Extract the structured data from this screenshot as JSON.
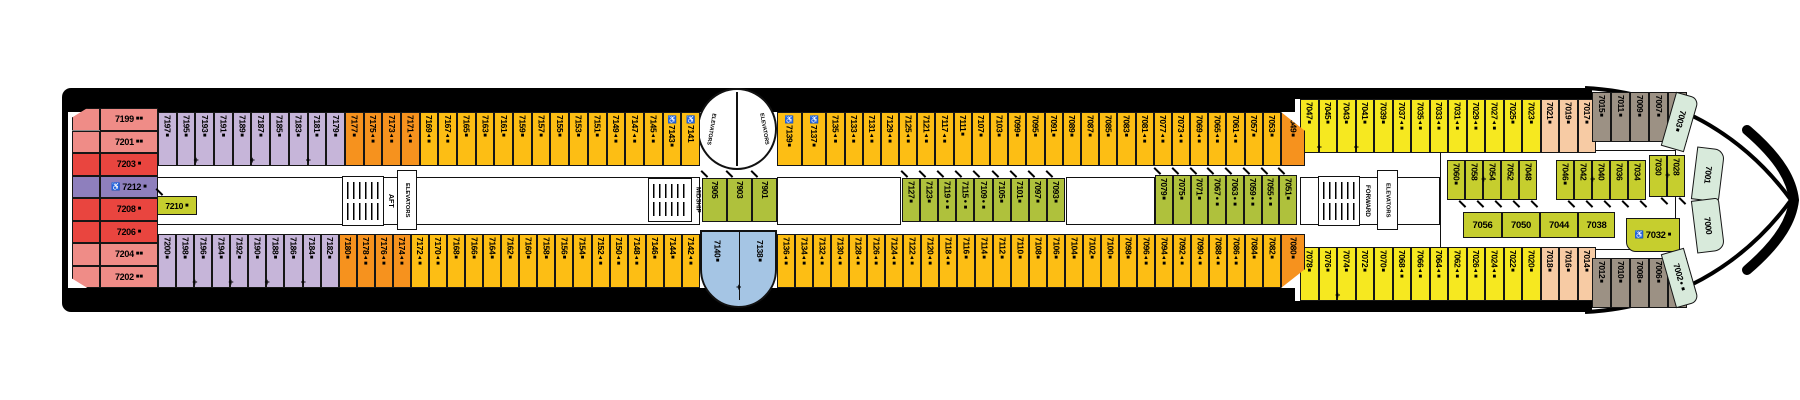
{
  "labels": {
    "aft": "AFT",
    "midship": "MIDSHIP",
    "forward": "FORWARD",
    "elevators": "ELEVATORS"
  },
  "colors": {
    "hull": "#000000",
    "deck": "#ffffff",
    "pink": "#EF8C87",
    "red": "#E9453F",
    "purple": "#8E7FBD",
    "lavender": "#C6B5D9",
    "orange": "#F6921E",
    "gold": "#FDBE14",
    "yellow": "#F6E820",
    "green": "#AFC13C",
    "yg": "#C6CE2E",
    "blue": "#A5C5E4",
    "peach": "#F7CBA4",
    "brown": "#9C9184",
    "palegreen": "#D8EADB"
  },
  "cabins": {
    "aft_stack": [
      {
        "n": "7199",
        "post": "■■",
        "c": "pink"
      },
      {
        "n": "7201",
        "post": "■■",
        "c": "pink"
      },
      {
        "n": "7203",
        "post": "■",
        "c": "red"
      },
      {
        "n": "7212",
        "pre": "♿",
        "post": "■",
        "c": "purple"
      },
      {
        "n": "7208",
        "post": "■",
        "c": "red"
      },
      {
        "n": "7206",
        "post": "■",
        "c": "red"
      },
      {
        "n": "7204",
        "post": "■■",
        "c": "pink"
      },
      {
        "n": "7202",
        "post": "■■",
        "c": "pink"
      }
    ],
    "cabin_7210": {
      "n": "7210",
      "post": "■",
      "c": "yg"
    },
    "top_a": [
      {
        "n": "7197",
        "post": "■",
        "c": "lavender"
      },
      {
        "n": "7195",
        "post": "■",
        "c": "lavender",
        "plus": true
      },
      {
        "n": "7193",
        "post": "■",
        "c": "lavender"
      },
      {
        "n": "7191",
        "post": "■",
        "c": "lavender"
      },
      {
        "n": "7189",
        "post": "■",
        "c": "lavender",
        "plus": true
      },
      {
        "n": "7187",
        "post": "■",
        "c": "lavender"
      },
      {
        "n": "7185",
        "post": "■",
        "c": "lavender"
      },
      {
        "n": "7183",
        "post": "■",
        "c": "lavender",
        "plus": true
      },
      {
        "n": "7181",
        "post": "■",
        "c": "lavender"
      },
      {
        "n": "7179",
        "post": "■",
        "c": "lavender"
      },
      {
        "n": "7177",
        "post": "■",
        "c": "orange"
      },
      {
        "n": "7175",
        "post": "▲■",
        "c": "orange"
      },
      {
        "n": "7173",
        "post": "▲■",
        "c": "orange"
      },
      {
        "n": "7171",
        "post": "▲■",
        "c": "orange"
      },
      {
        "n": "7169",
        "post": "▲■",
        "c": "gold"
      },
      {
        "n": "7167",
        "post": "▲■",
        "c": "gold"
      },
      {
        "n": "7165",
        "post": "■",
        "c": "gold"
      },
      {
        "n": "7163",
        "post": "■",
        "c": "gold"
      },
      {
        "n": "7161",
        "post": "■",
        "c": "gold"
      },
      {
        "n": "7159",
        "post": "■",
        "c": "gold"
      },
      {
        "n": "7157",
        "post": "■",
        "c": "gold"
      },
      {
        "n": "7155",
        "post": "■",
        "c": "gold"
      },
      {
        "n": "7153",
        "post": "■",
        "c": "gold"
      },
      {
        "n": "7151",
        "post": "■",
        "c": "gold"
      },
      {
        "n": "7149",
        "post": "▲■",
        "c": "gold"
      },
      {
        "n": "7147",
        "post": "▲■",
        "c": "gold"
      },
      {
        "n": "7145",
        "post": "▲■",
        "c": "gold"
      },
      {
        "n": "7143",
        "pre": "♿",
        "post": "■",
        "c": "gold"
      },
      {
        "n": "7141",
        "pre": "♿",
        "c": "gold"
      }
    ],
    "top_b": [
      {
        "n": "7139",
        "pre": "♿",
        "post": "■",
        "c": "gold"
      },
      {
        "n": "7137",
        "pre": "♿",
        "post": "■",
        "c": "gold"
      },
      {
        "n": "7135",
        "post": "▲■",
        "c": "gold"
      },
      {
        "n": "7133",
        "post": "▲■",
        "c": "gold"
      },
      {
        "n": "7131",
        "post": "▲■",
        "c": "gold"
      },
      {
        "n": "7129",
        "post": "▲■",
        "c": "gold"
      },
      {
        "n": "7125",
        "post": "▲■",
        "c": "gold"
      },
      {
        "n": "7121",
        "post": "▲■",
        "c": "gold"
      },
      {
        "n": "7117",
        "post": "▲■",
        "c": "gold"
      },
      {
        "n": "7111",
        "post": "■",
        "c": "gold"
      },
      {
        "n": "7107",
        "post": "■",
        "c": "gold"
      },
      {
        "n": "7103",
        "post": "■",
        "c": "gold"
      },
      {
        "n": "7099",
        "post": "■",
        "c": "gold"
      },
      {
        "n": "7095",
        "post": "■",
        "c": "gold"
      },
      {
        "n": "7091",
        "post": "■",
        "c": "gold"
      },
      {
        "n": "7089",
        "post": "■",
        "c": "gold"
      },
      {
        "n": "7087",
        "post": "■",
        "c": "gold"
      },
      {
        "n": "7085",
        "post": "■",
        "c": "gold"
      },
      {
        "n": "7083",
        "post": "■",
        "c": "gold"
      },
      {
        "n": "7081",
        "post": "▲■",
        "c": "gold"
      },
      {
        "n": "7077",
        "post": "▲■",
        "c": "gold"
      },
      {
        "n": "7073",
        "post": "▲■",
        "c": "gold"
      },
      {
        "n": "7069",
        "post": "▲■",
        "c": "gold"
      },
      {
        "n": "7065",
        "post": "▲■",
        "c": "gold"
      },
      {
        "n": "7061",
        "post": "▲■",
        "c": "gold"
      },
      {
        "n": "7057",
        "post": "■",
        "c": "gold"
      },
      {
        "n": "7053",
        "post": "■",
        "c": "gold"
      }
    ],
    "top_corner": {
      "n": "7049",
      "post": "■",
      "c": "orange"
    },
    "bottom_a": [
      {
        "n": "7200",
        "post": "■",
        "c": "lavender"
      },
      {
        "n": "7198",
        "post": "■",
        "c": "lavender",
        "plus": true
      },
      {
        "n": "7196",
        "post": "■",
        "c": "lavender"
      },
      {
        "n": "7194",
        "post": "■",
        "c": "lavender",
        "plus": true
      },
      {
        "n": "7192",
        "post": "■",
        "c": "lavender"
      },
      {
        "n": "7190",
        "post": "■",
        "c": "lavender",
        "plus": true
      },
      {
        "n": "7188",
        "post": "■",
        "c": "lavender"
      },
      {
        "n": "7186",
        "post": "■",
        "c": "lavender",
        "plus": true
      },
      {
        "n": "7184",
        "post": "■",
        "c": "lavender"
      },
      {
        "n": "7182",
        "post": "■",
        "c": "lavender"
      },
      {
        "n": "7180",
        "post": "■",
        "c": "orange"
      },
      {
        "n": "7178",
        "post": "▲■",
        "c": "orange"
      },
      {
        "n": "7176",
        "post": "▲■",
        "c": "orange"
      },
      {
        "n": "7174",
        "post": "▲■",
        "c": "orange"
      },
      {
        "n": "7172",
        "post": "▲■",
        "c": "gold"
      },
      {
        "n": "7170",
        "post": "▲■",
        "c": "gold"
      },
      {
        "n": "7168",
        "post": "■",
        "c": "gold"
      },
      {
        "n": "7166",
        "post": "■",
        "c": "gold"
      },
      {
        "n": "7164",
        "post": "■",
        "c": "gold"
      },
      {
        "n": "7162",
        "post": "■",
        "c": "gold"
      },
      {
        "n": "7160",
        "post": "■",
        "c": "gold"
      },
      {
        "n": "7158",
        "post": "■",
        "c": "gold"
      },
      {
        "n": "7156",
        "post": "■",
        "c": "gold"
      },
      {
        "n": "7154",
        "post": "■",
        "c": "gold"
      },
      {
        "n": "7152",
        "post": "▲■",
        "c": "gold"
      },
      {
        "n": "7150",
        "post": "▲■",
        "c": "gold"
      },
      {
        "n": "7148",
        "post": "▲■",
        "c": "gold"
      },
      {
        "n": "7146",
        "post": "■",
        "c": "gold"
      },
      {
        "n": "7144",
        "post": "■",
        "c": "gold"
      },
      {
        "n": "7142",
        "post": "▲■",
        "c": "gold"
      }
    ],
    "blue": [
      {
        "n": "7140",
        "post": "■",
        "c": "blue"
      },
      {
        "n": "7138",
        "post": "■",
        "c": "blue"
      }
    ],
    "bottom_b": [
      {
        "n": "7136",
        "post": "▲■",
        "c": "gold"
      },
      {
        "n": "7134",
        "post": "▲■",
        "c": "gold"
      },
      {
        "n": "7132",
        "post": "▲■",
        "c": "gold"
      },
      {
        "n": "7130",
        "post": "▲■",
        "c": "gold"
      },
      {
        "n": "7128",
        "post": "▲■",
        "c": "gold"
      },
      {
        "n": "7126",
        "post": "▲■",
        "c": "gold"
      },
      {
        "n": "7124",
        "post": "▲■",
        "c": "gold"
      },
      {
        "n": "7122",
        "post": "▲■",
        "c": "gold"
      },
      {
        "n": "7120",
        "post": "▲■",
        "c": "gold"
      },
      {
        "n": "7118",
        "post": "▲■",
        "c": "gold"
      },
      {
        "n": "7116",
        "post": "■",
        "c": "gold"
      },
      {
        "n": "7114",
        "post": "■",
        "c": "gold"
      },
      {
        "n": "7112",
        "post": "■",
        "c": "gold"
      },
      {
        "n": "7110",
        "post": "■",
        "c": "gold"
      },
      {
        "n": "7108",
        "post": "■",
        "c": "gold"
      },
      {
        "n": "7106",
        "post": "■",
        "c": "gold"
      },
      {
        "n": "7104",
        "post": "■",
        "c": "gold"
      },
      {
        "n": "7102",
        "post": "■",
        "c": "gold"
      },
      {
        "n": "7100",
        "post": "■",
        "c": "gold"
      },
      {
        "n": "7098",
        "post": "■",
        "c": "gold"
      },
      {
        "n": "7096",
        "post": "▲■",
        "c": "gold"
      },
      {
        "n": "7094",
        "post": "▲■",
        "c": "gold"
      },
      {
        "n": "7092",
        "post": "▲■",
        "c": "gold"
      },
      {
        "n": "7090",
        "post": "▲■",
        "c": "gold"
      },
      {
        "n": "7088",
        "post": "▲■",
        "c": "gold"
      },
      {
        "n": "7086",
        "post": "▲■",
        "c": "gold"
      },
      {
        "n": "7084",
        "post": "■",
        "c": "gold"
      },
      {
        "n": "7082",
        "post": "■",
        "c": "gold"
      }
    ],
    "bottom_corner": {
      "n": "7080",
      "post": "■",
      "c": "orange"
    },
    "top_fwd": [
      {
        "n": "7047",
        "post": "■",
        "c": "yellow",
        "plus": true
      },
      {
        "n": "7045",
        "post": "■",
        "c": "yellow"
      },
      {
        "n": "7043",
        "post": "■",
        "c": "yellow",
        "plus": true
      },
      {
        "n": "7041",
        "post": "■",
        "c": "yellow"
      },
      {
        "n": "7039",
        "post": "■",
        "c": "yellow"
      },
      {
        "n": "7037",
        "post": "▲■",
        "c": "yellow"
      },
      {
        "n": "7035",
        "post": "▲■",
        "c": "yellow"
      },
      {
        "n": "7033",
        "post": "▲■",
        "c": "yellow"
      },
      {
        "n": "7031",
        "post": "▲■",
        "c": "yellow"
      },
      {
        "n": "7029",
        "post": "▲■",
        "c": "yellow"
      },
      {
        "n": "7027",
        "post": "▲■",
        "c": "yellow"
      },
      {
        "n": "7025",
        "post": "■",
        "c": "yellow"
      },
      {
        "n": "7023",
        "post": "■",
        "c": "yellow"
      },
      {
        "n": "7021",
        "post": "■",
        "c": "peach"
      },
      {
        "n": "7019",
        "post": "■",
        "c": "peach"
      },
      {
        "n": "7017",
        "post": "■",
        "c": "peach"
      }
    ],
    "bottom_fwd": [
      {
        "n": "7078",
        "post": "■",
        "c": "yellow"
      },
      {
        "n": "7076",
        "post": "■",
        "c": "yellow",
        "plus": true
      },
      {
        "n": "7074",
        "post": "■",
        "c": "yellow"
      },
      {
        "n": "7072",
        "post": "■",
        "c": "yellow"
      },
      {
        "n": "7070",
        "post": "■",
        "c": "yellow"
      },
      {
        "n": "7068",
        "post": "▲■",
        "c": "yellow"
      },
      {
        "n": "7066",
        "post": "▲■",
        "c": "yellow"
      },
      {
        "n": "7064",
        "post": "▲■",
        "c": "yellow"
      },
      {
        "n": "7062",
        "post": "▲■",
        "c": "yellow"
      },
      {
        "n": "7026",
        "post": "▲■",
        "c": "yellow"
      },
      {
        "n": "7024",
        "post": "▲■",
        "c": "yellow"
      },
      {
        "n": "7022",
        "post": "■",
        "c": "yellow"
      },
      {
        "n": "7020",
        "post": "■",
        "c": "yellow"
      },
      {
        "n": "7018",
        "post": "■",
        "c": "peach"
      },
      {
        "n": "7016",
        "post": "■",
        "c": "peach"
      },
      {
        "n": "7014",
        "post": "■",
        "c": "peach"
      }
    ],
    "top_bow": [
      {
        "n": "7015",
        "post": "■",
        "c": "brown"
      },
      {
        "n": "7011",
        "post": "■",
        "c": "brown"
      },
      {
        "n": "7009",
        "post": "■",
        "c": "brown"
      },
      {
        "n": "7007",
        "post": "■",
        "c": "brown"
      },
      {
        "n": "7005",
        "post": "●■",
        "c": "brown"
      }
    ],
    "bottom_bow": [
      {
        "n": "7012",
        "post": "■",
        "c": "brown"
      },
      {
        "n": "7010",
        "post": "■",
        "c": "brown"
      },
      {
        "n": "7008",
        "post": "■",
        "c": "brown"
      },
      {
        "n": "7006",
        "post": "■",
        "c": "brown"
      },
      {
        "n": "7004",
        "post": "●■",
        "c": "brown"
      }
    ],
    "mid_aft_green": [
      {
        "n": "7905",
        "c": "green"
      },
      {
        "n": "7903",
        "c": "green"
      },
      {
        "n": "7901",
        "c": "green"
      }
    ],
    "mid_green": [
      {
        "n": "7127",
        "post": "■",
        "c": "green"
      },
      {
        "n": "7123",
        "post": "■",
        "c": "green"
      },
      {
        "n": "7119",
        "post": "●■",
        "c": "green"
      },
      {
        "n": "7115",
        "post": "●■",
        "c": "green"
      },
      {
        "n": "7109",
        "post": "●■",
        "c": "green"
      },
      {
        "n": "7105",
        "post": "■",
        "c": "green"
      },
      {
        "n": "7101",
        "post": "■",
        "c": "green"
      },
      {
        "n": "7097",
        "post": "■",
        "c": "green"
      },
      {
        "n": "7093",
        "post": "■",
        "c": "green"
      }
    ],
    "fwd_green": [
      {
        "n": "7079",
        "post": "■",
        "c": "green"
      },
      {
        "n": "7075",
        "post": "■",
        "c": "green"
      },
      {
        "n": "7071",
        "post": "■",
        "c": "green"
      },
      {
        "n": "7067",
        "post": "●■",
        "c": "green"
      },
      {
        "n": "7063",
        "post": "●■",
        "c": "green"
      },
      {
        "n": "7059",
        "post": "●■",
        "c": "green"
      },
      {
        "n": "7055",
        "post": "●■",
        "c": "green"
      },
      {
        "n": "7051",
        "post": "■",
        "c": "green"
      }
    ],
    "bow_green_top": [
      {
        "n": "7060",
        "post": "■",
        "c": "yg"
      },
      {
        "n": "7058",
        "c": "yg",
        "plus": true
      },
      {
        "n": "7054",
        "c": "yg"
      },
      {
        "n": "7052",
        "c": "yg"
      },
      {
        "n": "7048",
        "c": "yg"
      },
      {
        "n": "7046",
        "post": "■",
        "c": "yg"
      },
      {
        "n": "7042",
        "c": "yg",
        "plus": true
      },
      {
        "n": "7040",
        "c": "yg"
      },
      {
        "n": "7036",
        "c": "yg"
      },
      {
        "n": "7034",
        "c": "yg"
      },
      {
        "n": "7030",
        "c": "yg",
        "plus": true
      },
      {
        "n": "7028",
        "c": "yg"
      }
    ],
    "bow_green_bottom": [
      {
        "n": "7056",
        "c": "yg"
      },
      {
        "n": "7050",
        "c": "yg"
      },
      {
        "n": "7044",
        "c": "yg"
      },
      {
        "n": "7038",
        "c": "yg"
      },
      {
        "n": "7032",
        "pre": "♿",
        "post": "■",
        "c": "yg"
      }
    ],
    "bow_curve": [
      {
        "n": "7003",
        "post": "■",
        "c": "palegreen"
      },
      {
        "n": "7001",
        "c": "palegreen"
      },
      {
        "n": "7000",
        "c": "palegreen"
      },
      {
        "n": "7002",
        "post": "●■",
        "c": "palegreen"
      }
    ]
  }
}
